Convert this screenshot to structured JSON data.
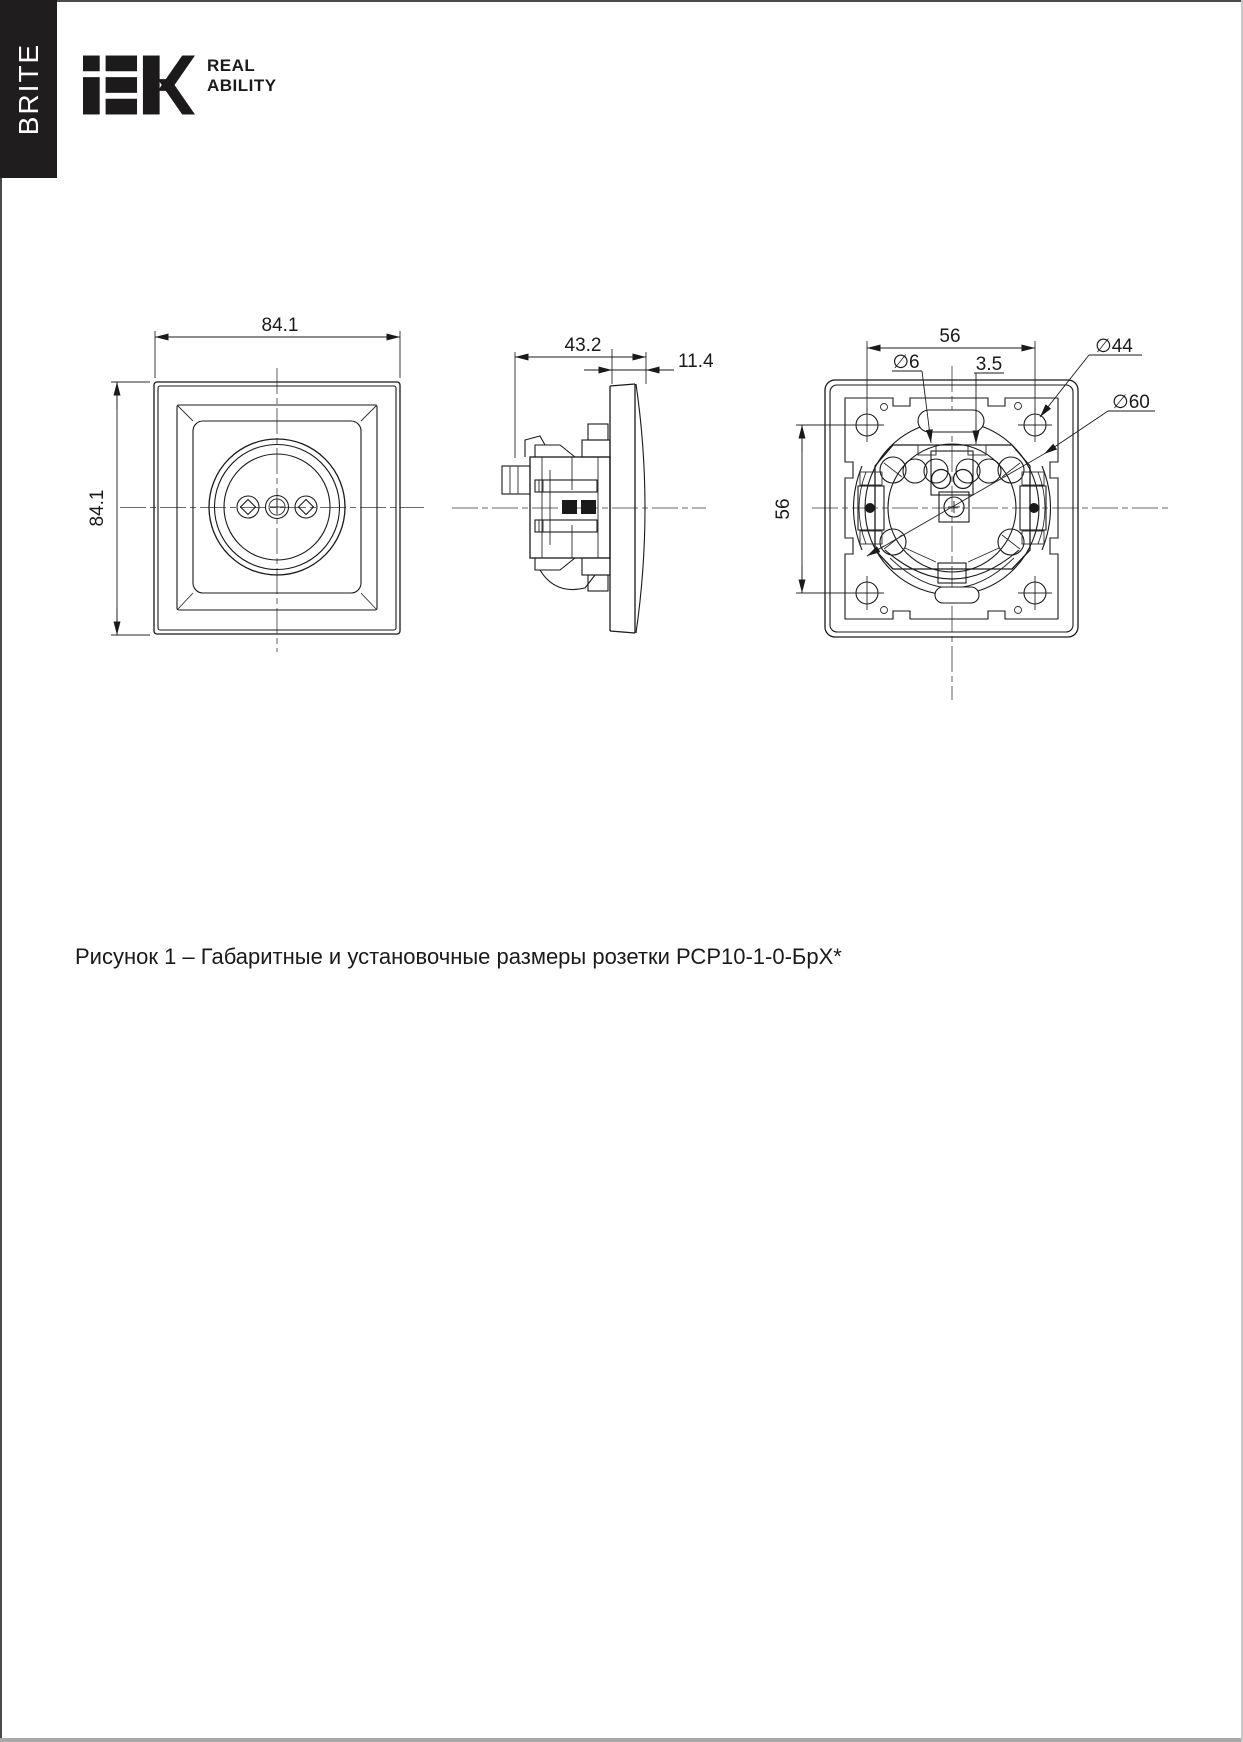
{
  "page": {
    "series_label": "BRITE",
    "logo": {
      "brand": "IEK",
      "tagline_line1": "REAL",
      "tagline_line2": "ABILITY"
    },
    "caption": "Рисунок 1 – Габаритные и установочные размеры розетки РСР10-1-0-БрХ*"
  },
  "drawing": {
    "front_view": {
      "width": "84.1",
      "height": "84.1"
    },
    "side_view": {
      "depth": "43.2",
      "thickness": "11.4"
    },
    "back_view": {
      "spacing_h": "56",
      "spacing_v": "56",
      "hole_d": "∅6",
      "gap": "3.5",
      "d44": "∅44",
      "d60": "∅60"
    }
  }
}
